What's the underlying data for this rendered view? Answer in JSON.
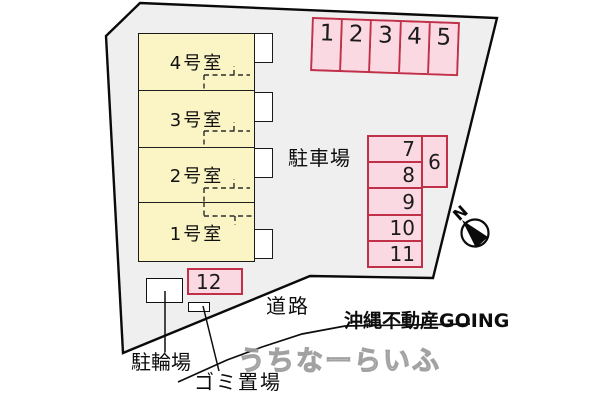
{
  "site_plan": {
    "building": {
      "rooms": [
        {
          "label": "4号室"
        },
        {
          "label": "3号室"
        },
        {
          "label": "2号室"
        },
        {
          "label": "1号室"
        }
      ]
    },
    "parking": {
      "area_label": "駐車場",
      "top_row_spaces": [
        "1",
        "2",
        "3",
        "4",
        "5"
      ],
      "right_column_spaces": [
        "7",
        "8",
        "9",
        "10",
        "11"
      ],
      "side_space": "6",
      "bottom_space": "12"
    },
    "labels": {
      "road": "道路",
      "bicycle_parking": "駐輪場",
      "garbage_area": "ゴミ置場"
    },
    "compass": {
      "north": "N"
    },
    "watermarks": {
      "company": "沖縄不動産GOING",
      "site": "うちなーらいふ"
    },
    "colors": {
      "lot_fill": "#efefef",
      "room_fill": "#fbf5c5",
      "parking_fill": "#fbd9e3",
      "parking_border": "#c03049",
      "outline": "#111111"
    }
  }
}
